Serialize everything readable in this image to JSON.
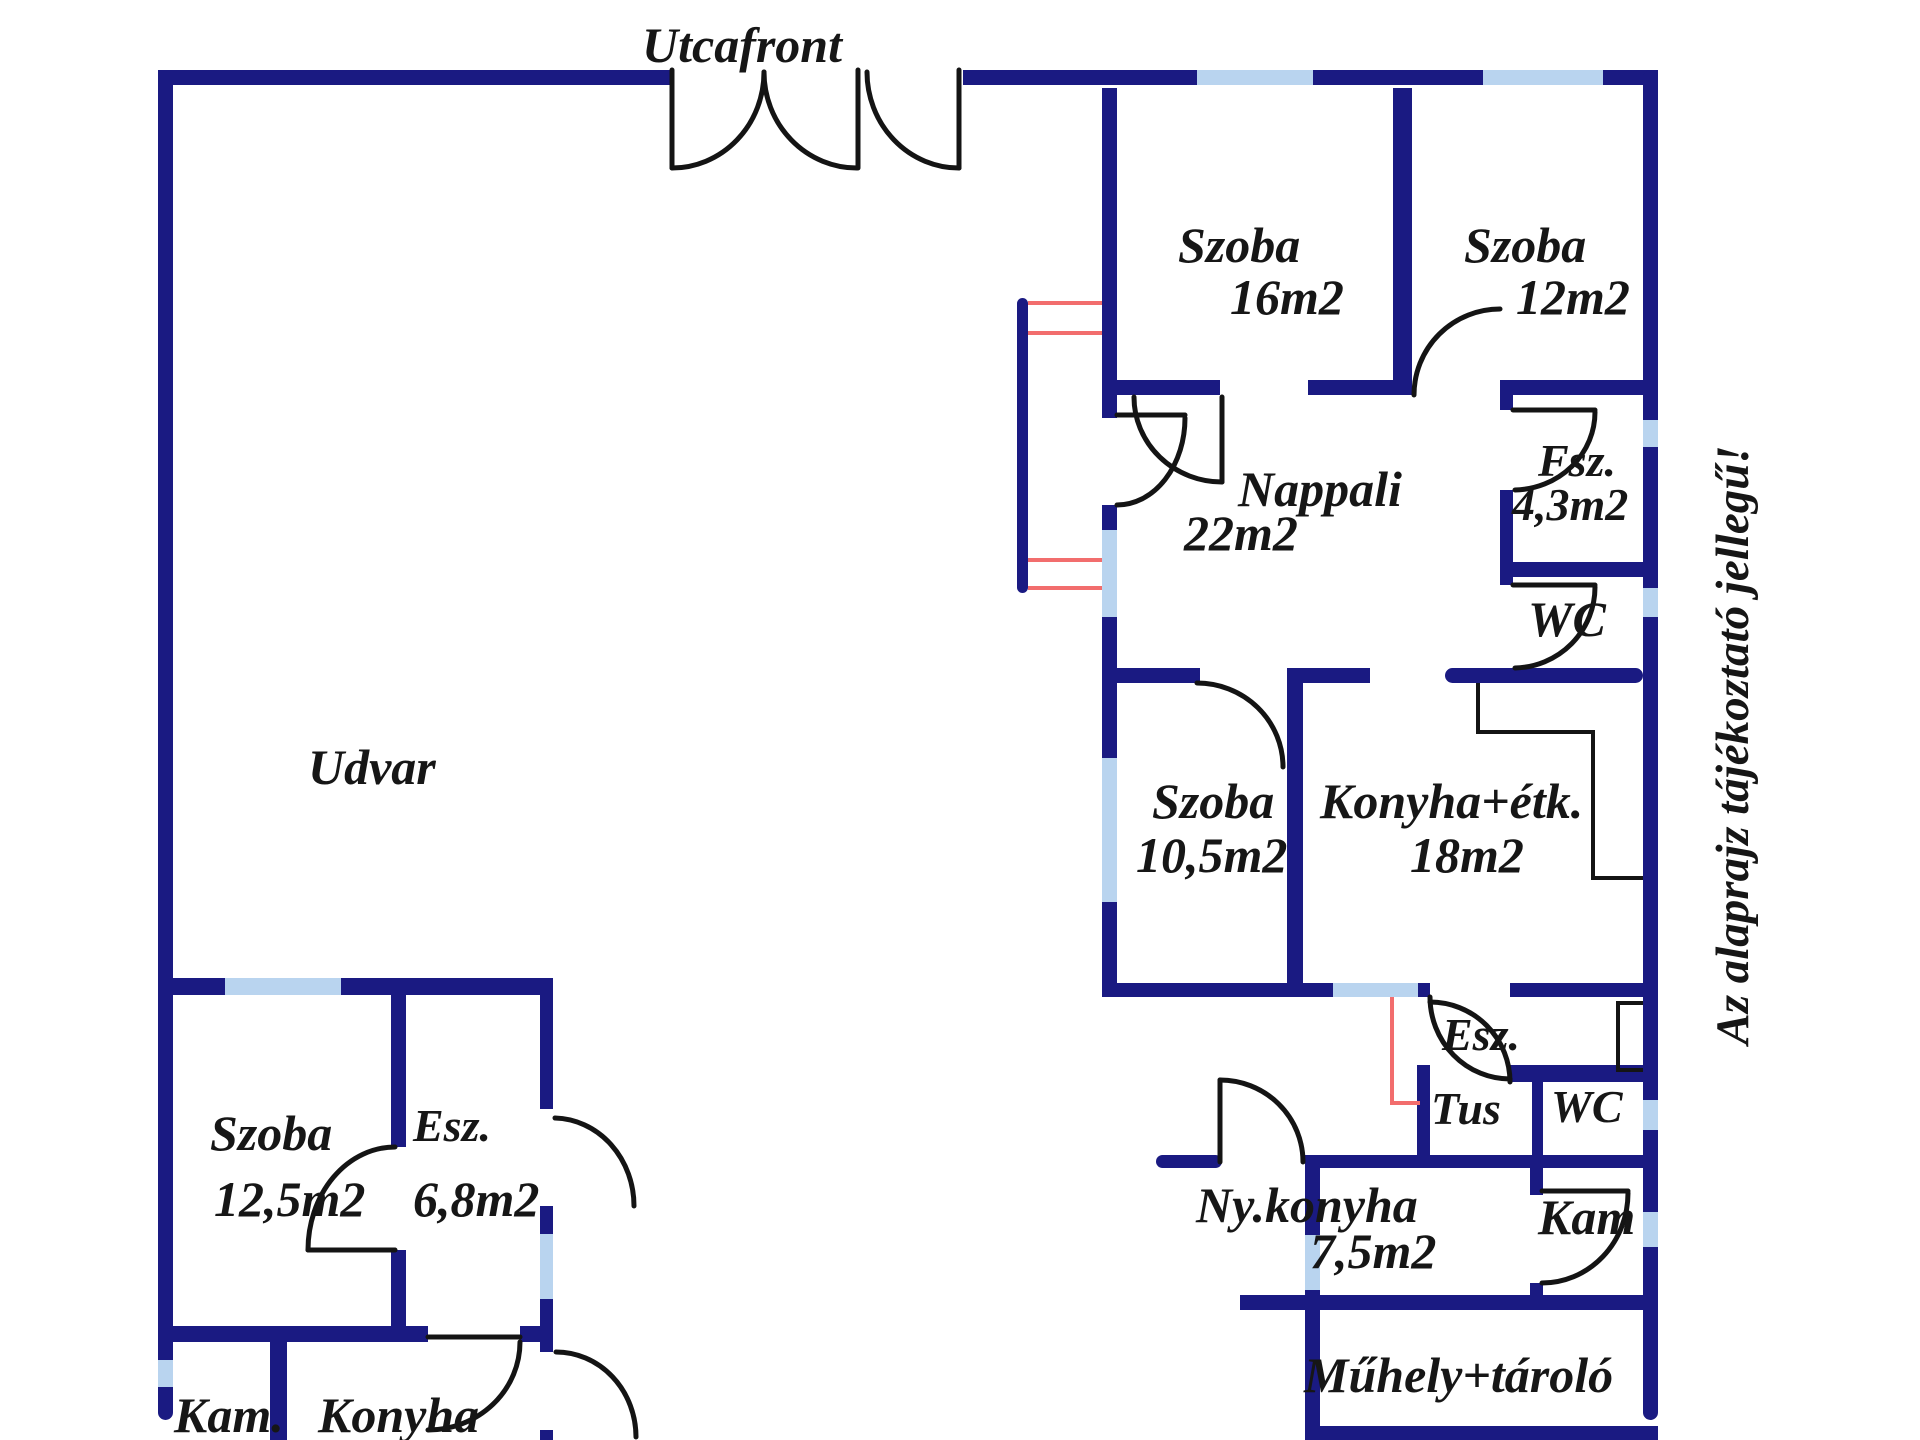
{
  "plan_title": "Utcafront",
  "labels": {
    "utcafront": "Utcafront",
    "udvar": "Udvar",
    "szoba16_name": "Szoba",
    "szoba16_area": "16m2",
    "szoba12_name": "Szoba",
    "szoba12_area": "12m2",
    "nappali_name": "Nappali",
    "nappali_area": "22m2",
    "fsz_name": "Fsz.",
    "fsz_area": "4,3m2",
    "wc_upper": "WC",
    "szoba105_name": "Szoba",
    "szoba105_area": "10,5m2",
    "konyha_etk_name": "Konyha+étk.",
    "konyha_etk_area": "18m2",
    "esz_right": "Esz.",
    "tus": "Tus",
    "wc_lower": "WC",
    "nykonyha_name": "Ny.konyha",
    "nykonyha_area": "7,5m2",
    "kam_right": "Kam",
    "muhely": "Műhely+tároló",
    "szoba125_name": "Szoba",
    "szoba125_area": "12,5m2",
    "esz_left_name": "Esz.",
    "esz_left_area": "6,8m2",
    "kam_left": "Kam.",
    "konyha_left": "Konyha",
    "disclaimer": "Az alaprajz tájékoztató jellegű!"
  },
  "colors": {
    "wall": "#1a1a82",
    "window": "#b9d4ef",
    "door_line": "#141414",
    "accent_red": "#f26d6d",
    "text": "#161616",
    "background": "#ffffff"
  }
}
